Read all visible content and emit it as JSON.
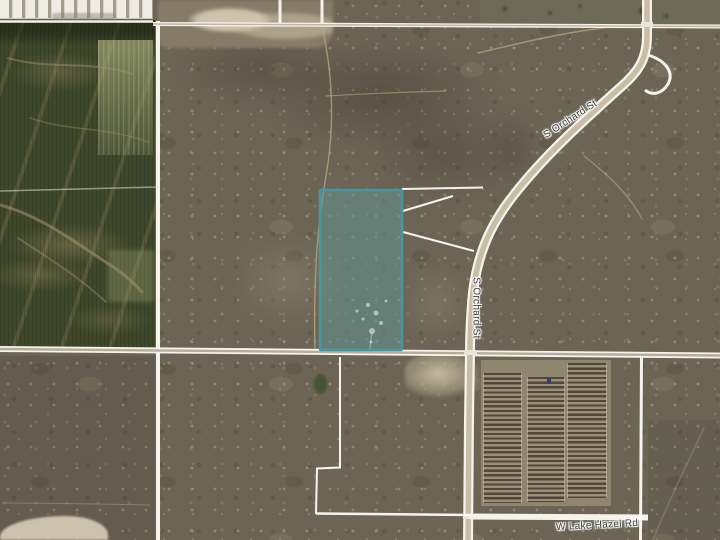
{
  "map": {
    "road_labels": [
      {
        "text": "S Orchard St",
        "orientation": "diagonal-upper"
      },
      {
        "text": "S Orchard St",
        "orientation": "vertical-lower"
      },
      {
        "text": "W Lake Hazel Rd",
        "orientation": "horizontal-bottom"
      }
    ],
    "highlight_parcel": {
      "fill": "rgba(96,150,148,0.55)",
      "stroke": "#4897a0"
    }
  }
}
